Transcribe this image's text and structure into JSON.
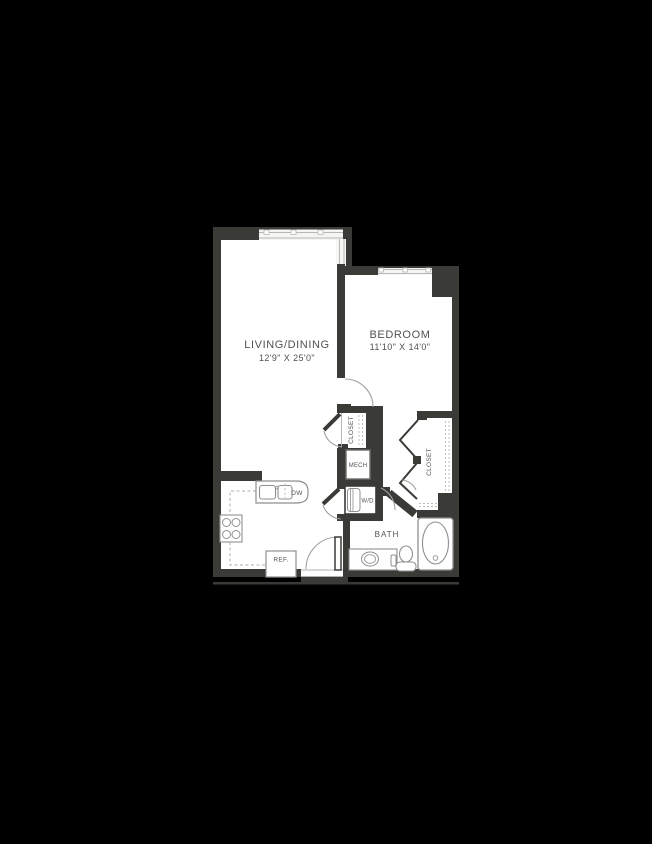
{
  "canvas": {
    "background": "#000000"
  },
  "plan": {
    "colors": {
      "wall": "#3a3a36",
      "floor": "#ffffff",
      "window_fill": "#f5f5f3",
      "window_frame": "#b8b8b6",
      "fixture_line": "#8f8f8f",
      "dash_line": "#bcbcbc",
      "door_arc": "#a0a0a0",
      "text": "#505154"
    },
    "living": {
      "label": "LIVING/DINING",
      "dimensions": "12'9\" X 25'0\""
    },
    "bedroom": {
      "label": "BEDROOM",
      "dimensions": "11'10\" X 14'0\""
    },
    "bath": {
      "label": "BATH"
    },
    "hall_closet": {
      "label": "CLOSET"
    },
    "bedroom_closet": {
      "label": "CLOSET"
    },
    "mech": {
      "label": "MECH"
    },
    "washer_dryer": {
      "label": "W/D"
    },
    "dishwasher": {
      "label": "DW"
    },
    "refrigerator": {
      "label": "REF."
    }
  }
}
